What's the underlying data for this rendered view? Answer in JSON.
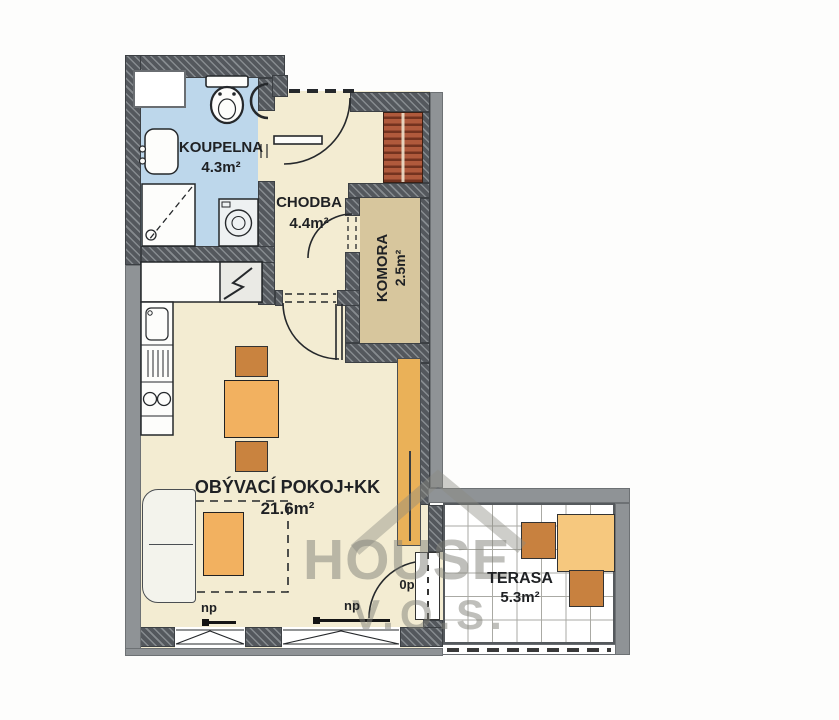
{
  "document": {
    "type": "apartment-floor-plan"
  },
  "rooms": [
    {
      "name": "KOUPELNA",
      "area": "4.3m²"
    },
    {
      "name": "CHODBA",
      "area": "4.4m²"
    },
    {
      "name": "KOMORA",
      "area": "2.5m²"
    },
    {
      "name": "OBÝVACÍ POKOJ+KK",
      "area": "21.6m²"
    },
    {
      "name": "TERASA",
      "area": "5.3m²"
    }
  ],
  "annotations": {
    "window_left": "np",
    "window_right": "np",
    "terrace_door": "0p"
  },
  "watermark": {
    "brand": "HOUSE",
    "suffix": "V.O.S."
  },
  "colors": {
    "wall_dark": "#54585d",
    "wall_plain": "#8f9396",
    "bathroom_floor": "#bdd7eb",
    "hall_floor": "#f3ecd2",
    "storage_floor": "#d7c69d",
    "living_floor": "#f3ecd2",
    "terrace_floor": "#ffffff",
    "furniture_light": "#f2b160",
    "furniture_dark": "#c9833f",
    "closet_red": "#b05a3c"
  }
}
